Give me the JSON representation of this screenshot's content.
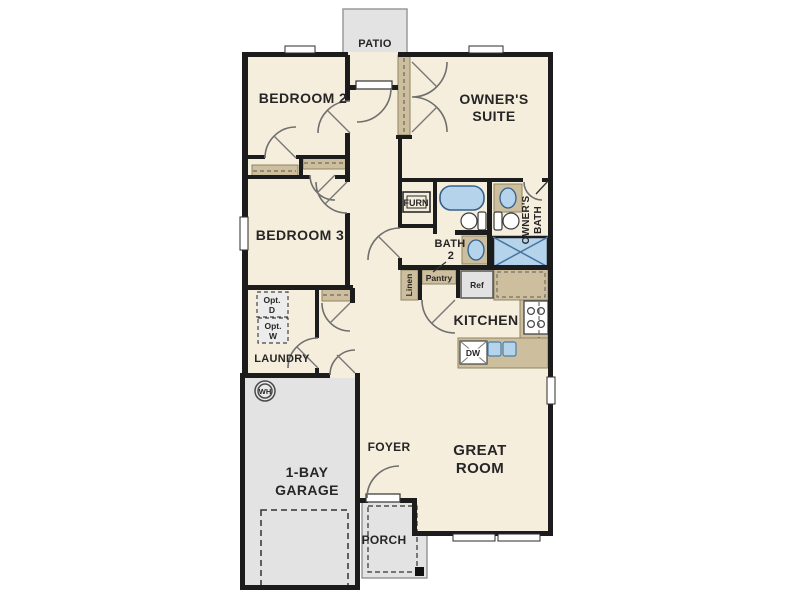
{
  "plan_type": "residential floor plan",
  "colors": {
    "wall": "#1c1c1c",
    "floor": "#f6eedd",
    "outdoor_gray": "#e3e3e3",
    "casework_tan": "#cdbf9d",
    "fixture_blue": "#b5d3eb",
    "fixture_blue_stroke": "#4a7fa8",
    "label": "#262626"
  },
  "rooms": {
    "patio": "PATIO",
    "bedroom2": "BEDROOM 2",
    "owners_suite": [
      "OWNER'S",
      "SUITE"
    ],
    "bedroom3": "BEDROOM 3",
    "owners_bath": [
      "OWNER'S",
      "BATH"
    ],
    "bath2": [
      "BATH",
      "2"
    ],
    "kitchen": "KITCHEN",
    "laundry": "LAUNDRY",
    "foyer": "FOYER",
    "great_room": [
      "GREAT",
      "ROOM"
    ],
    "garage": [
      "1-BAY",
      "GARAGE"
    ],
    "porch": "PORCH"
  },
  "labels": {
    "furnace": "FURN",
    "linen": "Linen",
    "pantry": "Pantry",
    "refrigerator": "Ref",
    "dishwasher": "DW",
    "water_heater": "WH",
    "opt_dryer": [
      "Opt.",
      "D"
    ],
    "opt_washer": [
      "Opt.",
      "W"
    ]
  }
}
